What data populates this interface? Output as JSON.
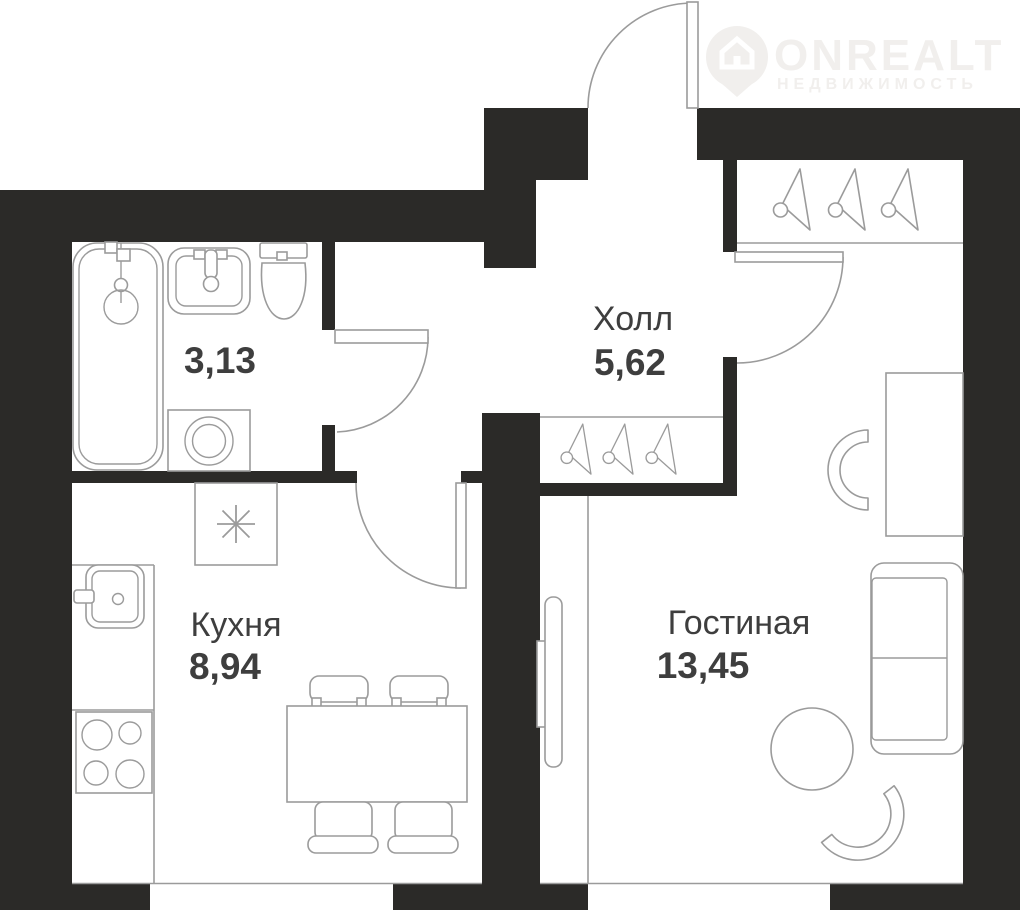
{
  "logo": {
    "name": "ONREALT",
    "subtitle": "НЕДВИЖИМОСТЬ",
    "icon": "house-pin-icon"
  },
  "rooms": {
    "bathroom": {
      "area": "3,13"
    },
    "hall": {
      "name": "Холл",
      "area": "5,62"
    },
    "kitchen": {
      "name": "Кухня",
      "area": "8,94"
    },
    "living": {
      "name": "Гостиная",
      "area": "13,45"
    }
  },
  "icons": {
    "hanger": "clothes-hanger-icon",
    "vent": "asterisk-mark",
    "logo_pin": "house-pin-icon"
  },
  "colors": {
    "background": "#ffffff",
    "wall": "#2b2a28",
    "line": "#9b9b9b",
    "label": "#3e3e3e",
    "logo": "#f1efed"
  }
}
